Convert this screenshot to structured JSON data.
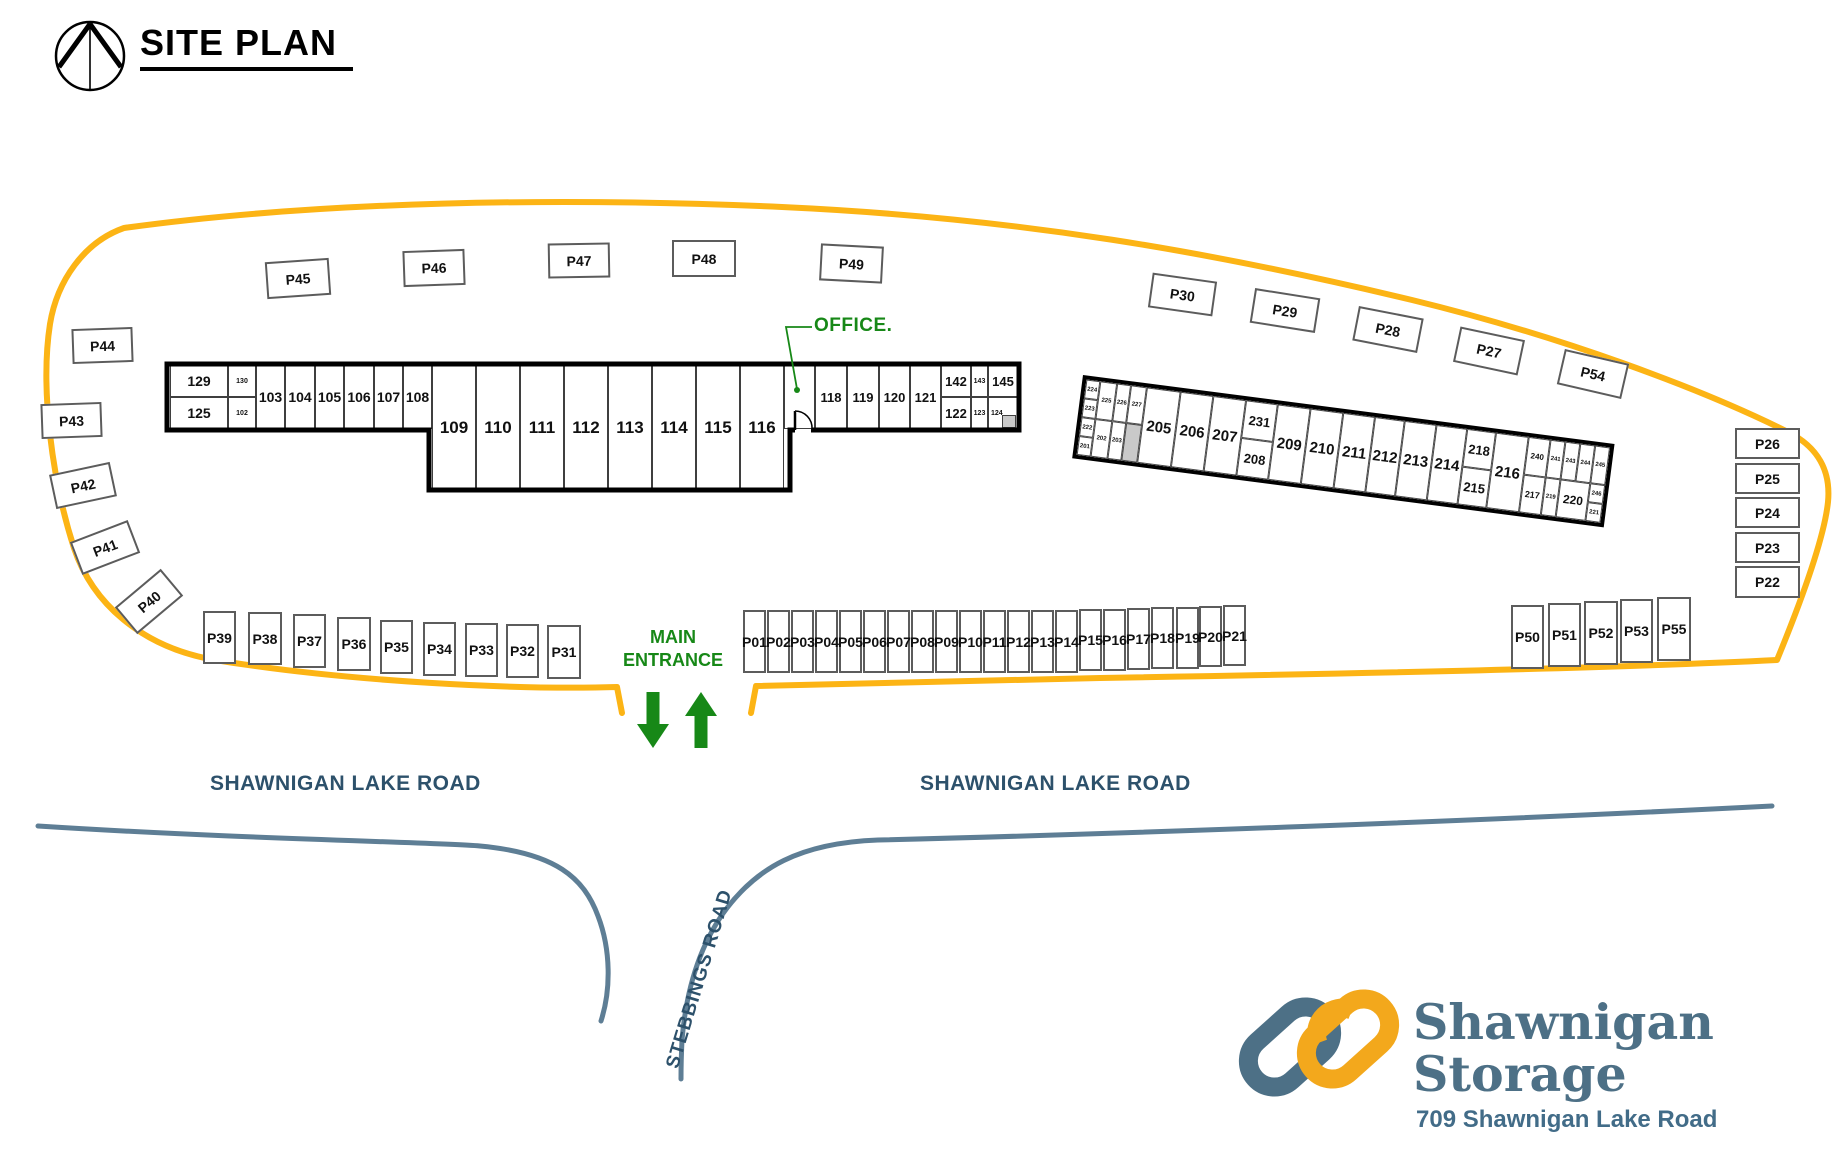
{
  "site_title": "SITE PLAN",
  "labels": {
    "office": "OFFICE.",
    "main_entrance_line1": "MAIN",
    "main_entrance_line2": "ENTRANCE",
    "road_left": "SHAWNIGAN LAKE ROAD",
    "road_right": "SHAWNIGAN LAKE ROAD",
    "stebbings": "STEBBINGS ROAD"
  },
  "logo": {
    "line1": "Shawnigan",
    "line2": "Storage",
    "address": "709 Shawnigan Lake Road"
  },
  "colors": {
    "boundary_yellow": "#FCB415",
    "road_blue": "#5E7E95",
    "road_text": "#2D516B",
    "green": "#178817",
    "logo_blue": "#4D7086",
    "logo_yellow": "#F3A81C",
    "gray_cell": "#C9C9C9"
  },
  "parking": {
    "stalls": [
      {
        "label": "P45",
        "x": 266,
        "y": 260,
        "w": 64,
        "h": 37,
        "r": -4
      },
      {
        "label": "P46",
        "x": 403,
        "y": 250,
        "w": 62,
        "h": 36,
        "r": -2
      },
      {
        "label": "P47",
        "x": 548,
        "y": 243,
        "w": 62,
        "h": 35,
        "r": -1
      },
      {
        "label": "P48",
        "x": 672,
        "y": 240,
        "w": 64,
        "h": 37,
        "r": 0
      },
      {
        "label": "P49",
        "x": 820,
        "y": 245,
        "w": 63,
        "h": 37,
        "r": 3
      },
      {
        "label": "P30",
        "x": 1150,
        "y": 277,
        "w": 65,
        "h": 35,
        "r": 8
      },
      {
        "label": "P29",
        "x": 1252,
        "y": 293,
        "w": 66,
        "h": 35,
        "r": 9
      },
      {
        "label": "P28",
        "x": 1355,
        "y": 312,
        "w": 66,
        "h": 35,
        "r": 11
      },
      {
        "label": "P27",
        "x": 1456,
        "y": 333,
        "w": 66,
        "h": 36,
        "r": 12
      },
      {
        "label": "P54",
        "x": 1560,
        "y": 356,
        "w": 66,
        "h": 36,
        "r": 13
      },
      {
        "label": "P44",
        "x": 72,
        "y": 328,
        "w": 61,
        "h": 35,
        "r": -2
      },
      {
        "label": "P43",
        "x": 41,
        "y": 403,
        "w": 61,
        "h": 35,
        "r": -2
      },
      {
        "label": "P42",
        "x": 52,
        "y": 468,
        "w": 62,
        "h": 35,
        "r": -12
      },
      {
        "label": "P41",
        "x": 74,
        "y": 530,
        "w": 62,
        "h": 35,
        "r": -21
      },
      {
        "label": "P40",
        "x": 119,
        "y": 584,
        "w": 60,
        "h": 35,
        "r": -40
      },
      {
        "label": "P39",
        "x": 203,
        "y": 611,
        "w": 33,
        "h": 53,
        "r": 0
      },
      {
        "label": "P38",
        "x": 248,
        "y": 612,
        "w": 34,
        "h": 53,
        "r": 0
      },
      {
        "label": "P37",
        "x": 293,
        "y": 614,
        "w": 33,
        "h": 54,
        "r": 0
      },
      {
        "label": "P36",
        "x": 337,
        "y": 617,
        "w": 34,
        "h": 54,
        "r": 0
      },
      {
        "label": "P35",
        "x": 380,
        "y": 620,
        "w": 33,
        "h": 54,
        "r": 0
      },
      {
        "label": "P34",
        "x": 423,
        "y": 622,
        "w": 33,
        "h": 54,
        "r": 0
      },
      {
        "label": "P33",
        "x": 465,
        "y": 623,
        "w": 33,
        "h": 54,
        "r": 0
      },
      {
        "label": "P32",
        "x": 506,
        "y": 624,
        "w": 33,
        "h": 54,
        "r": 0
      },
      {
        "label": "P31",
        "x": 547,
        "y": 625,
        "w": 34,
        "h": 54,
        "r": 0
      },
      {
        "label": "P01",
        "x": 743,
        "y": 610,
        "w": 23,
        "h": 63,
        "r": 0
      },
      {
        "label": "P02",
        "x": 767,
        "y": 610,
        "w": 23,
        "h": 63,
        "r": 0
      },
      {
        "label": "P03",
        "x": 791,
        "y": 610,
        "w": 23,
        "h": 63,
        "r": 0
      },
      {
        "label": "P04",
        "x": 815,
        "y": 610,
        "w": 23,
        "h": 63,
        "r": 0
      },
      {
        "label": "P05",
        "x": 839,
        "y": 610,
        "w": 23,
        "h": 63,
        "r": 0
      },
      {
        "label": "P06",
        "x": 863,
        "y": 610,
        "w": 23,
        "h": 63,
        "r": 0
      },
      {
        "label": "P07",
        "x": 887,
        "y": 610,
        "w": 23,
        "h": 63,
        "r": 0
      },
      {
        "label": "P08",
        "x": 911,
        "y": 610,
        "w": 23,
        "h": 63,
        "r": 0
      },
      {
        "label": "P09",
        "x": 935,
        "y": 610,
        "w": 23,
        "h": 63,
        "r": 0
      },
      {
        "label": "P10",
        "x": 959,
        "y": 610,
        "w": 23,
        "h": 63,
        "r": 0
      },
      {
        "label": "P11",
        "x": 983,
        "y": 610,
        "w": 23,
        "h": 63,
        "r": 0
      },
      {
        "label": "P12",
        "x": 1007,
        "y": 610,
        "w": 23,
        "h": 63,
        "r": 0
      },
      {
        "label": "P13",
        "x": 1031,
        "y": 610,
        "w": 23,
        "h": 63,
        "r": 0
      },
      {
        "label": "P14",
        "x": 1055,
        "y": 610,
        "w": 23,
        "h": 63,
        "r": 0
      },
      {
        "label": "P15",
        "x": 1079,
        "y": 609,
        "w": 23,
        "h": 62,
        "r": 0
      },
      {
        "label": "P16",
        "x": 1103,
        "y": 609,
        "w": 23,
        "h": 62,
        "r": 0
      },
      {
        "label": "P17",
        "x": 1127,
        "y": 608,
        "w": 23,
        "h": 62,
        "r": 0
      },
      {
        "label": "P18",
        "x": 1151,
        "y": 607,
        "w": 23,
        "h": 62,
        "r": 0
      },
      {
        "label": "P19",
        "x": 1176,
        "y": 607,
        "w": 23,
        "h": 62,
        "r": 0
      },
      {
        "label": "P20",
        "x": 1199,
        "y": 606,
        "w": 23,
        "h": 61,
        "r": 0
      },
      {
        "label": "P21",
        "x": 1223,
        "y": 605,
        "w": 23,
        "h": 61,
        "r": 0
      },
      {
        "label": "P50",
        "x": 1511,
        "y": 605,
        "w": 33,
        "h": 64,
        "r": 0
      },
      {
        "label": "P51",
        "x": 1548,
        "y": 603,
        "w": 33,
        "h": 64,
        "r": 0
      },
      {
        "label": "P52",
        "x": 1584,
        "y": 601,
        "w": 34,
        "h": 64,
        "r": 0
      },
      {
        "label": "P53",
        "x": 1620,
        "y": 599,
        "w": 33,
        "h": 64,
        "r": 0
      },
      {
        "label": "P55",
        "x": 1657,
        "y": 597,
        "w": 34,
        "h": 64,
        "r": 0
      },
      {
        "label": "P26",
        "x": 1735,
        "y": 428,
        "w": 65,
        "h": 31,
        "r": 0
      },
      {
        "label": "P25",
        "x": 1735,
        "y": 463,
        "w": 65,
        "h": 31,
        "r": 0
      },
      {
        "label": "P24",
        "x": 1735,
        "y": 497,
        "w": 65,
        "h": 31,
        "r": 0
      },
      {
        "label": "P23",
        "x": 1735,
        "y": 532,
        "w": 65,
        "h": 31,
        "r": 0
      },
      {
        "label": "P22",
        "x": 1735,
        "y": 566,
        "w": 65,
        "h": 32,
        "r": 0
      }
    ]
  },
  "building_a": {
    "cells": [
      {
        "label": "129",
        "x": 170,
        "y": 365,
        "w": 58,
        "h": 32,
        "fs": 14
      },
      {
        "label": "130",
        "x": 228,
        "y": 365,
        "w": 28,
        "h": 32,
        "fs": 7
      },
      {
        "label": "125",
        "x": 170,
        "y": 397,
        "w": 58,
        "h": 32,
        "fs": 14
      },
      {
        "label": "102",
        "x": 228,
        "y": 397,
        "w": 28,
        "h": 32,
        "fs": 7
      },
      {
        "label": "103",
        "x": 256,
        "y": 365,
        "w": 29,
        "h": 64,
        "fs": 14
      },
      {
        "label": "104",
        "x": 285,
        "y": 365,
        "w": 30,
        "h": 64,
        "fs": 14
      },
      {
        "label": "105",
        "x": 315,
        "y": 365,
        "w": 29,
        "h": 64,
        "fs": 14
      },
      {
        "label": "106",
        "x": 344,
        "y": 365,
        "w": 30,
        "h": 64,
        "fs": 14
      },
      {
        "label": "107",
        "x": 374,
        "y": 365,
        "w": 29,
        "h": 64,
        "fs": 14
      },
      {
        "label": "108",
        "x": 403,
        "y": 365,
        "w": 29,
        "h": 64,
        "fs": 14
      },
      {
        "label": "109",
        "x": 432,
        "y": 365,
        "w": 44,
        "h": 124,
        "fs": 17
      },
      {
        "label": "110",
        "x": 476,
        "y": 365,
        "w": 44,
        "h": 124,
        "fs": 17
      },
      {
        "label": "111",
        "x": 520,
        "y": 365,
        "w": 44,
        "h": 124,
        "fs": 17
      },
      {
        "label": "112",
        "x": 564,
        "y": 365,
        "w": 44,
        "h": 124,
        "fs": 17
      },
      {
        "label": "113",
        "x": 608,
        "y": 365,
        "w": 44,
        "h": 124,
        "fs": 17
      },
      {
        "label": "114",
        "x": 652,
        "y": 365,
        "w": 44,
        "h": 124,
        "fs": 17
      },
      {
        "label": "115",
        "x": 696,
        "y": 365,
        "w": 44,
        "h": 124,
        "fs": 17
      },
      {
        "label": "116",
        "x": 740,
        "y": 365,
        "w": 44,
        "h": 124,
        "fs": 17
      },
      {
        "label": "",
        "x": 784,
        "y": 365,
        "w": 31,
        "h": 64,
        "fs": 13,
        "name": "office-room"
      },
      {
        "label": "118",
        "x": 815,
        "y": 365,
        "w": 32,
        "h": 64,
        "fs": 13
      },
      {
        "label": "119",
        "x": 847,
        "y": 365,
        "w": 32,
        "h": 64,
        "fs": 13
      },
      {
        "label": "120",
        "x": 879,
        "y": 365,
        "w": 31,
        "h": 64,
        "fs": 13
      },
      {
        "label": "121",
        "x": 910,
        "y": 365,
        "w": 31,
        "h": 64,
        "fs": 13
      },
      {
        "label": "142",
        "x": 941,
        "y": 365,
        "w": 30,
        "h": 32,
        "fs": 13
      },
      {
        "label": "143",
        "x": 971,
        "y": 365,
        "w": 17,
        "h": 32,
        "fs": 7
      },
      {
        "label": "145",
        "x": 988,
        "y": 365,
        "w": 30,
        "h": 32,
        "fs": 13
      },
      {
        "label": "122",
        "x": 941,
        "y": 397,
        "w": 30,
        "h": 32,
        "fs": 13
      },
      {
        "label": "123",
        "x": 971,
        "y": 397,
        "w": 17,
        "h": 32,
        "fs": 7
      },
      {
        "label": "124",
        "x": 988,
        "y": 397,
        "w": 30,
        "h": 32,
        "fs": 7,
        "leftpad": true
      },
      {
        "label": "",
        "x": 1002,
        "y": 415,
        "w": 14,
        "h": 13,
        "fs": 6,
        "gray": true,
        "name": "shaded-cell"
      }
    ]
  },
  "building_b": {
    "rotation_deg": 7.4,
    "cells": [
      {
        "label": "224",
        "x": 0,
        "y": 0,
        "w": 14,
        "h": 19,
        "fs": 6
      },
      {
        "label": "223",
        "x": 0,
        "y": 19,
        "w": 14,
        "h": 19,
        "fs": 6
      },
      {
        "label": "222",
        "x": 0,
        "y": 38,
        "w": 14,
        "h": 19,
        "fs": 6
      },
      {
        "label": "201",
        "x": 0,
        "y": 57,
        "w": 14,
        "h": 19,
        "fs": 6
      },
      {
        "label": "225",
        "x": 14,
        "y": 0,
        "w": 17,
        "h": 38,
        "fs": 6
      },
      {
        "label": "202",
        "x": 14,
        "y": 38,
        "w": 17,
        "h": 38,
        "fs": 6
      },
      {
        "label": "226",
        "x": 31,
        "y": 0,
        "w": 14,
        "h": 38,
        "fs": 6
      },
      {
        "label": "203",
        "x": 31,
        "y": 38,
        "w": 14,
        "h": 38,
        "fs": 6
      },
      {
        "label": "227",
        "x": 45,
        "y": 0,
        "w": 16,
        "h": 38,
        "fs": 6
      },
      {
        "label": "",
        "x": 45,
        "y": 38,
        "w": 16,
        "h": 38,
        "fs": 6,
        "gray": true,
        "name": "shaded-cell"
      },
      {
        "label": "205",
        "x": 61,
        "y": 0,
        "w": 34,
        "h": 76,
        "fs": 15
      },
      {
        "label": "206",
        "x": 95,
        "y": 0,
        "w": 33,
        "h": 76,
        "fs": 15
      },
      {
        "label": "207",
        "x": 128,
        "y": 0,
        "w": 33,
        "h": 76,
        "fs": 15
      },
      {
        "label": "231",
        "x": 161,
        "y": 0,
        "w": 32,
        "h": 38,
        "fs": 13
      },
      {
        "label": "208",
        "x": 161,
        "y": 38,
        "w": 32,
        "h": 38,
        "fs": 13
      },
      {
        "label": "209",
        "x": 193,
        "y": 0,
        "w": 33,
        "h": 76,
        "fs": 15
      },
      {
        "label": "210",
        "x": 226,
        "y": 0,
        "w": 33,
        "h": 76,
        "fs": 15
      },
      {
        "label": "211",
        "x": 259,
        "y": 0,
        "w": 32,
        "h": 76,
        "fs": 15
      },
      {
        "label": "212",
        "x": 291,
        "y": 0,
        "w": 30,
        "h": 76,
        "fs": 15
      },
      {
        "label": "213",
        "x": 321,
        "y": 0,
        "w": 32,
        "h": 76,
        "fs": 15
      },
      {
        "label": "214",
        "x": 353,
        "y": 0,
        "w": 31,
        "h": 76,
        "fs": 15
      },
      {
        "label": "218",
        "x": 384,
        "y": 0,
        "w": 29,
        "h": 38,
        "fs": 13
      },
      {
        "label": "215",
        "x": 384,
        "y": 38,
        "w": 29,
        "h": 38,
        "fs": 13
      },
      {
        "label": "216",
        "x": 413,
        "y": 0,
        "w": 33,
        "h": 76,
        "fs": 15
      },
      {
        "label": "240",
        "x": 446,
        "y": 0,
        "w": 22,
        "h": 38,
        "fs": 8
      },
      {
        "label": "241",
        "x": 468,
        "y": 0,
        "w": 15,
        "h": 38,
        "fs": 6
      },
      {
        "label": "243",
        "x": 483,
        "y": 0,
        "w": 15,
        "h": 38,
        "fs": 6
      },
      {
        "label": "244",
        "x": 498,
        "y": 0,
        "w": 15,
        "h": 38,
        "fs": 6
      },
      {
        "label": "245",
        "x": 513,
        "y": 0,
        "w": 15,
        "h": 38,
        "fs": 6
      },
      {
        "label": "217",
        "x": 446,
        "y": 38,
        "w": 22,
        "h": 38,
        "fs": 9
      },
      {
        "label": "219",
        "x": 468,
        "y": 38,
        "w": 15,
        "h": 38,
        "fs": 6
      },
      {
        "label": "220",
        "x": 483,
        "y": 38,
        "w": 30,
        "h": 38,
        "fs": 12
      },
      {
        "label": "246",
        "x": 513,
        "y": 38,
        "w": 15,
        "h": 19,
        "fs": 6
      },
      {
        "label": "221",
        "x": 513,
        "y": 57,
        "w": 15,
        "h": 19,
        "fs": 6
      }
    ]
  }
}
